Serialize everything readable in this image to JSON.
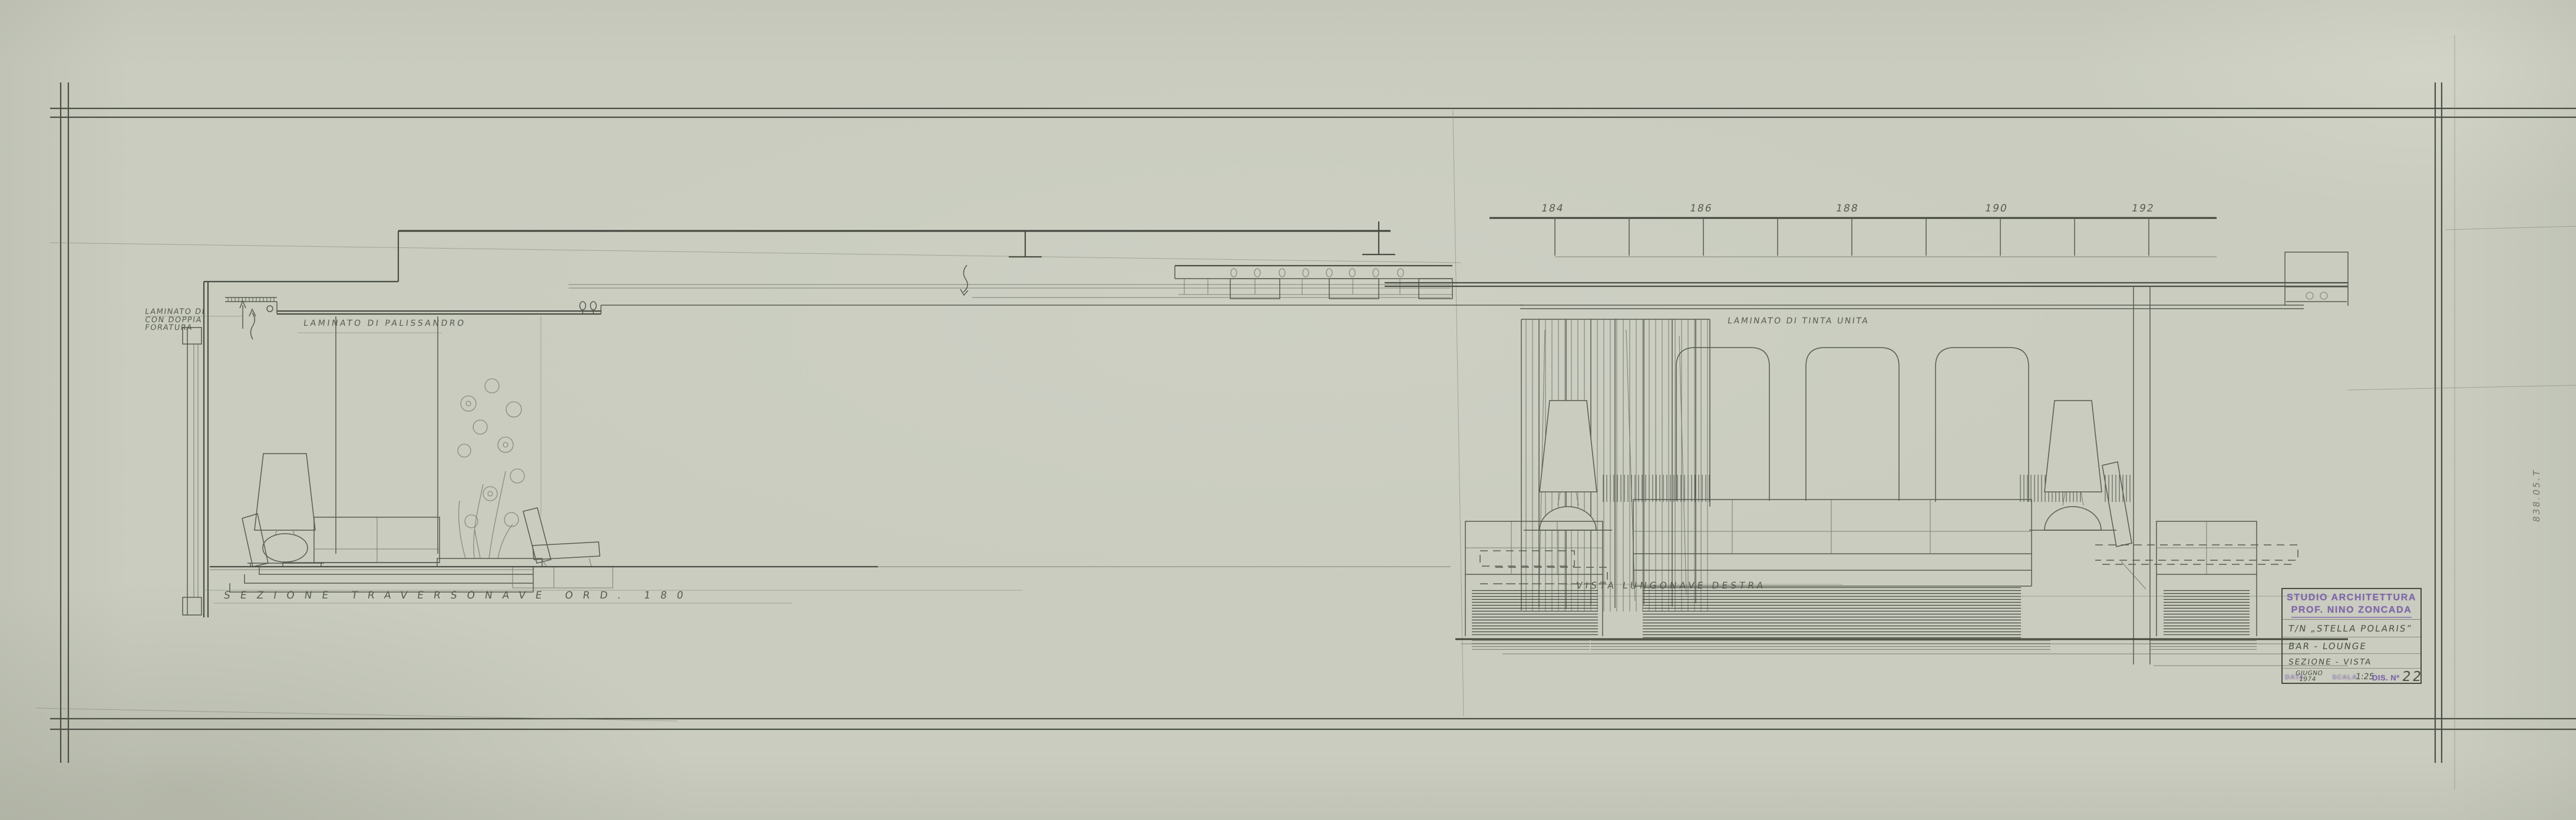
{
  "colors": {
    "paper": "#c9ccbf",
    "pencil": "#4c5046",
    "pencil-dark": "#3f4339",
    "stamp": "#7c60a8"
  },
  "sheet": {
    "margin_note": "838.05.T"
  },
  "title_block": {
    "studio": "STUDIO ARCHITETTURA",
    "architect": "PROF. NINO ZONCADA",
    "ship": "T/N „STELLA POLARIS”",
    "room": "BAR - LOUNGE",
    "content": "SEZIONE - VISTA",
    "date_label": "DATA",
    "date_month": "GIUGNO",
    "date_year": "1974",
    "scale_label": "SCALA",
    "scale_value": "1:25",
    "number_label": "DIS. Nº",
    "number_value": "22"
  },
  "cross_section": {
    "caption": "SEZIONE TRAVERSONAVE ORD. 180",
    "label_perforated_line1": "LAMINATO DI",
    "label_perforated_line2": "CON DOPPIA",
    "label_perforated_line3": "FORATURA",
    "label_wall": "LAMINATO DI PALISSANDRO"
  },
  "longitudinal_view": {
    "caption": "VISTA LUNGONAVE DESTRA",
    "label_wall": "LAMINATO DI TINTA UNITA",
    "frame_numbers": [
      "184",
      "186",
      "188",
      "190",
      "192"
    ]
  }
}
